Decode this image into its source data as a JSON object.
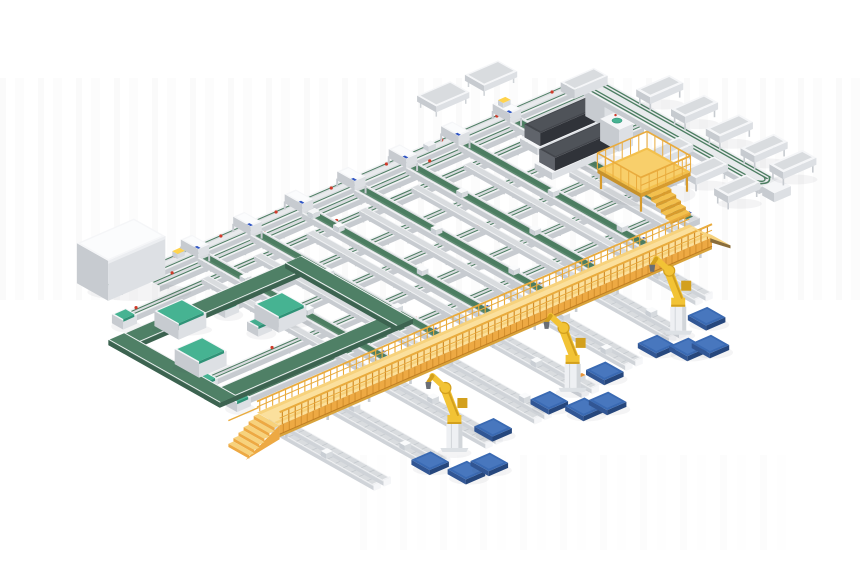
{
  "meta": {
    "description": "3D render of an automated parcel sorting / intralogistics system layout",
    "canvas": {
      "width": 860,
      "height": 580,
      "background": "#ffffff"
    }
  },
  "iso": {
    "origin": [
      195,
      258
    ],
    "u": [
      0.92,
      -0.4
    ],
    "v": [
      0.87,
      0.49
    ]
  },
  "palette": {
    "white_top": "#f5f6f8",
    "white_side": "#dde0e4",
    "white_dark": "#c7cbd0",
    "bed": "#d9dcdf",
    "bed_dark": "#c3c8cd",
    "rail": "#f2f3f5",
    "rail_edge": "#cfd3d7",
    "belt_green": "#4c7d61",
    "belt_green_dark": "#3a5f4a",
    "belt_green_light": "#6d9a80",
    "ring_green": "#4f8066",
    "ring_green_dark": "#3c6350",
    "mint": "#46b392",
    "mint_dark": "#2f9377",
    "gantry_deck": "#f7d27c",
    "gantry_walk": "#fbe3a3",
    "gantry_face": "#eda943",
    "gantry_rib": "#d28e2c",
    "gantry_edge": "#bf7d22",
    "gantry_rail": "#e9ab3d",
    "platform_yellow": "#f3c04d",
    "platform_dark": "#d89c2e",
    "robot_yellow": "#f2c335",
    "robot_shade": "#d3a01d",
    "robot_dark": "#8a6c12",
    "pedestal": "#eef0f3",
    "pedestal_side": "#d2d6da",
    "pallet_top": "#3a6ab3",
    "pallet_light": "#4d7cc2",
    "pallet_side": "#26477d",
    "pallet_side2": "#315694",
    "slab": "#43464c",
    "slab_dark": "#303339",
    "slab_light": "#60646b",
    "red": "#cf3a2a",
    "blue": "#2f55c2",
    "yellow_item": "#ffd34d",
    "orange": "#e8963a",
    "gripper": "#6a6e75",
    "shadow_soft": "rgba(60,70,80,0.06)",
    "shadow": "rgba(60,70,80,0.10)"
  },
  "scene": {
    "layers": [
      {
        "type": "ulines",
        "name": "main-feed-lines",
        "items": [
          {
            "v": 0,
            "w": 14,
            "u0": -95,
            "u1": 420,
            "style": "feeder",
            "dots": [
              -20,
              30,
              90,
              150,
              210,
              270,
              330,
              390
            ]
          },
          {
            "v": 18,
            "w": 10,
            "u0": -60,
            "u1": 420,
            "style": "striped",
            "dots": [
              -40,
              60,
              240
            ]
          },
          {
            "v": 40,
            "w": 9,
            "u0": -120,
            "u1": 418,
            "style": "striped",
            "cap": true,
            "dots": [
              -100,
              118
            ]
          },
          {
            "v": 78,
            "w": 9,
            "u0": -45,
            "u1": 410,
            "style": "striped",
            "cap": true,
            "dots": [
              20
            ]
          },
          {
            "v": 116,
            "w": 9,
            "u0": -45,
            "u1": 408,
            "style": "striped",
            "cap": true,
            "dots": [
              200
            ]
          },
          {
            "v": 154,
            "w": 9,
            "u0": -140,
            "u1": 382,
            "style": "striped",
            "cap": true,
            "dots": [
              -60
            ]
          },
          {
            "v": 192,
            "w": 9,
            "u0": -140,
            "u1": 320,
            "style": "striped",
            "cap": true,
            "dots": [
              60
            ]
          }
        ]
      },
      {
        "type": "vgreens",
        "name": "green-belt-conveyors",
        "v0": 10,
        "v1": 222,
        "items": [
          {
            "u": 0
          },
          {
            "u": 57
          },
          {
            "u": 113
          },
          {
            "u": 170
          },
          {
            "u": 226
          },
          {
            "u": 283
          },
          {
            "u": 339,
            "v1": 215
          }
        ],
        "parcels": [
          [
            0,
            60
          ],
          [
            0,
            128
          ],
          [
            57,
            95
          ],
          [
            57,
            170
          ],
          [
            113,
            48
          ],
          [
            113,
            140
          ],
          [
            170,
            100
          ],
          [
            170,
            185
          ],
          [
            226,
            70
          ],
          [
            226,
            150
          ],
          [
            283,
            115
          ],
          [
            283,
            190
          ],
          [
            339,
            60
          ],
          [
            339,
            140
          ]
        ]
      },
      {
        "type": "lanes",
        "name": "white-roller-lanes",
        "items": [
          {
            "u": -21,
            "v0": 34,
            "v1": 222
          },
          {
            "u": 36,
            "v0": 34,
            "v1": 222
          },
          {
            "u": 93,
            "v0": 34,
            "v1": 222
          },
          {
            "u": 150,
            "v0": 34,
            "v1": 222
          },
          {
            "u": 207,
            "v0": 34,
            "v1": 222
          },
          {
            "u": 264,
            "v0": 34,
            "v1": 222
          },
          {
            "u": 321,
            "v0": 95,
            "v1": 218
          }
        ]
      },
      {
        "type": "ring",
        "name": "left-loop-conveyor",
        "bands": [
          {
            "u0": -148,
            "v0": 57,
            "u1": 62,
            "v1": 75
          },
          {
            "u0": -148,
            "v0": 167,
            "u1": 62,
            "v1": 185
          },
          {
            "u0": -148,
            "v0": 57,
            "u1": -130,
            "v1": 185
          },
          {
            "u0": 44,
            "v0": 57,
            "u1": 62,
            "v1": 185
          }
        ]
      },
      {
        "type": "loopmachines",
        "name": "loop-machines",
        "items": [
          {
            "u0": -99,
            "v0": 58,
            "u1": -69,
            "v1": 86,
            "h": 15
          },
          {
            "u0": -128,
            "v0": 112,
            "u1": -98,
            "v1": 140,
            "h": 15
          },
          {
            "u0": -30,
            "v0": 100,
            "u1": 0,
            "v1": 128,
            "h": 15
          }
        ]
      },
      {
        "type": "bigbox",
        "name": "infeed-machine",
        "u0": -100,
        "v0": -30,
        "u1": -38,
        "v1": 6,
        "h": 40
      },
      {
        "type": "darkmachines",
        "name": "scanner-machines",
        "items": [
          {
            "u0": 322,
            "v0": 33,
            "u1": 408,
            "v1": 53
          },
          {
            "u0": 304,
            "v0": 69,
            "u1": 390,
            "v1": 89
          }
        ]
      },
      {
        "type": "tables",
        "name": "side-tables",
        "items": [
          {
            "u0": 300,
            "v0": -62,
            "u1": 336,
            "v1": -40,
            "h": 10
          },
          {
            "u0": 352,
            "v0": -62,
            "u1": 388,
            "v1": -40,
            "h": 10
          }
        ]
      },
      {
        "type": "stations",
        "name": "induction-stations",
        "u": [
          0,
          57,
          113,
          170,
          226,
          283,
          339
        ],
        "yellow": [
          339
        ]
      },
      {
        "type": "feederitems",
        "name": "feeder-parcels",
        "items": [
          {
            "u": -16,
            "v": -2,
            "h": 7.5,
            "c": "yellow_item"
          },
          {
            "u": 112,
            "v": 18,
            "h": 6.0,
            "c": "white_top"
          },
          {
            "u": 255,
            "v": 0,
            "h": 7.5,
            "c": "white_top"
          }
        ]
      },
      {
        "type": "spine",
        "name": "sorter-spine",
        "u0": 414,
        "u1": 436,
        "v0": 2,
        "v1": 210,
        "stripes": [
          417,
          420.5,
          429.5,
          433
        ],
        "legsStep": 36,
        "endbox": [
          416,
          212,
          434,
          226
        ],
        "junction": [
          406,
          -9,
          442,
          7
        ]
      },
      {
        "type": "trays",
        "name": "sorter-trays",
        "items": [
          {
            "u0": 378,
            "v0": 120,
            "u1": 413,
            "v1": 136
          },
          {
            "u0": 378,
            "v0": 160,
            "u1": 413,
            "v1": 176
          },
          {
            "u0": 378,
            "v0": 197,
            "u1": 413,
            "v1": 213
          },
          {
            "u0": 438,
            "v0": 44,
            "u1": 474,
            "v1": 60
          },
          {
            "u0": 438,
            "v0": 84,
            "u1": 474,
            "v1": 100
          },
          {
            "u0": 438,
            "v0": 124,
            "u1": 474,
            "v1": 140
          },
          {
            "u0": 438,
            "v0": 164,
            "u1": 474,
            "v1": 180
          },
          {
            "u0": 438,
            "v0": 197,
            "u1": 474,
            "v1": 213
          }
        ]
      },
      {
        "type": "platform",
        "name": "operator-platform",
        "u0": 322,
        "v0": 122,
        "u1": 376,
        "v1": 172,
        "h": 20,
        "railH": 36,
        "stairs": {
          "u0": 328,
          "u1": 350,
          "v": 172,
          "steps": 5
        }
      },
      {
        "type": "spurs",
        "name": "output-roller-spurs",
        "v0": 226,
        "items": [
          {
            "u": -135,
            "v1": 358
          },
          {
            "u": -78,
            "v1": 366
          },
          {
            "u": -21,
            "v1": 366
          },
          {
            "u": 36,
            "v1": 362
          },
          {
            "u": 93,
            "v1": 356
          },
          {
            "u": 150,
            "v1": 346
          },
          {
            "u": 207,
            "v1": 336
          },
          {
            "u": 264,
            "v1": 306
          }
        ],
        "parcels": [
          [
            -135,
            300
          ],
          [
            -78,
            260
          ],
          [
            -78,
            330
          ],
          [
            -21,
            290
          ],
          [
            36,
            250
          ],
          [
            36,
            335
          ],
          [
            93,
            300
          ],
          [
            150,
            260
          ],
          [
            150,
            320
          ],
          [
            207,
            300
          ],
          [
            264,
            260
          ]
        ],
        "orange": [
          [
            -21,
            250
          ],
          [
            93,
            340
          ],
          [
            207,
            250
          ]
        ]
      },
      {
        "type": "gantry",
        "name": "gantry-walkway",
        "u0": -152,
        "u1": 318,
        "v0": 232,
        "v1": 258,
        "h": 20,
        "legs": [
          -140,
          -95,
          -50,
          -5,
          40,
          85,
          130,
          175,
          220,
          265,
          310
        ],
        "stairs": {
          "steps": 6,
          "du": 5.5
        },
        "ramp": {
          "du": 22
        }
      },
      {
        "type": "robots",
        "name": "palletizing-robots",
        "anchors": [
          [
            -50,
            351
          ],
          [
            88,
            341
          ],
          [
            215,
            328
          ]
        ]
      },
      {
        "type": "pallets",
        "name": "floor-pallets",
        "size": 21,
        "items": [
          [
            245,
            329
          ],
          [
            184,
            336
          ],
          [
            123,
            341
          ],
          [
            57,
            347
          ],
          [
            -7,
            350
          ],
          [
            200,
            355
          ],
          [
            -82,
            357
          ],
          [
            217,
            363
          ],
          [
            71,
            372
          ],
          [
            92,
            377
          ],
          [
            -70,
            386
          ],
          [
            -47,
            388
          ]
        ]
      }
    ]
  }
}
